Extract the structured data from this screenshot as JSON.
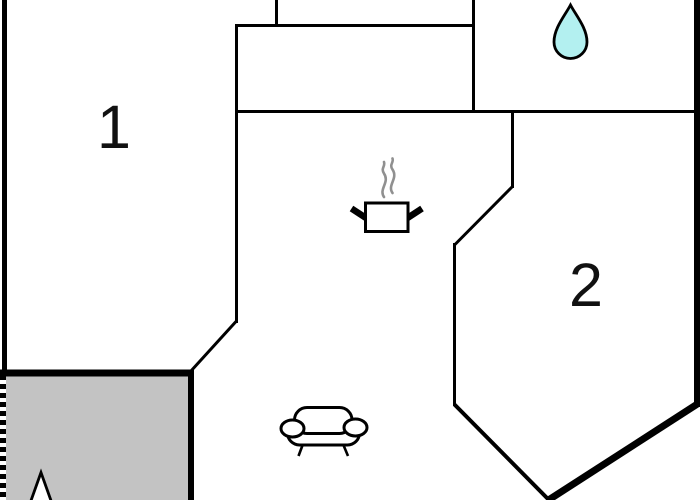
{
  "plan": {
    "type": "apartment-floor-plan",
    "rooms": [
      {
        "label": "1"
      },
      {
        "label": "2"
      }
    ],
    "icons": {
      "water_drop": "water-drop (bathroom)",
      "cooking_pot": "cooking-pot with steam (kitchen)",
      "sofa": "sofa (living area)",
      "north_arrow": "north-arrow tip (terrace)"
    },
    "colors": {
      "background": "#ffffff",
      "wall": "#000000",
      "terrace_fill": "#c3c3c3",
      "water_drop_fill": "#b3f0f0",
      "steam": "#909090",
      "label_text": "#111111"
    }
  }
}
